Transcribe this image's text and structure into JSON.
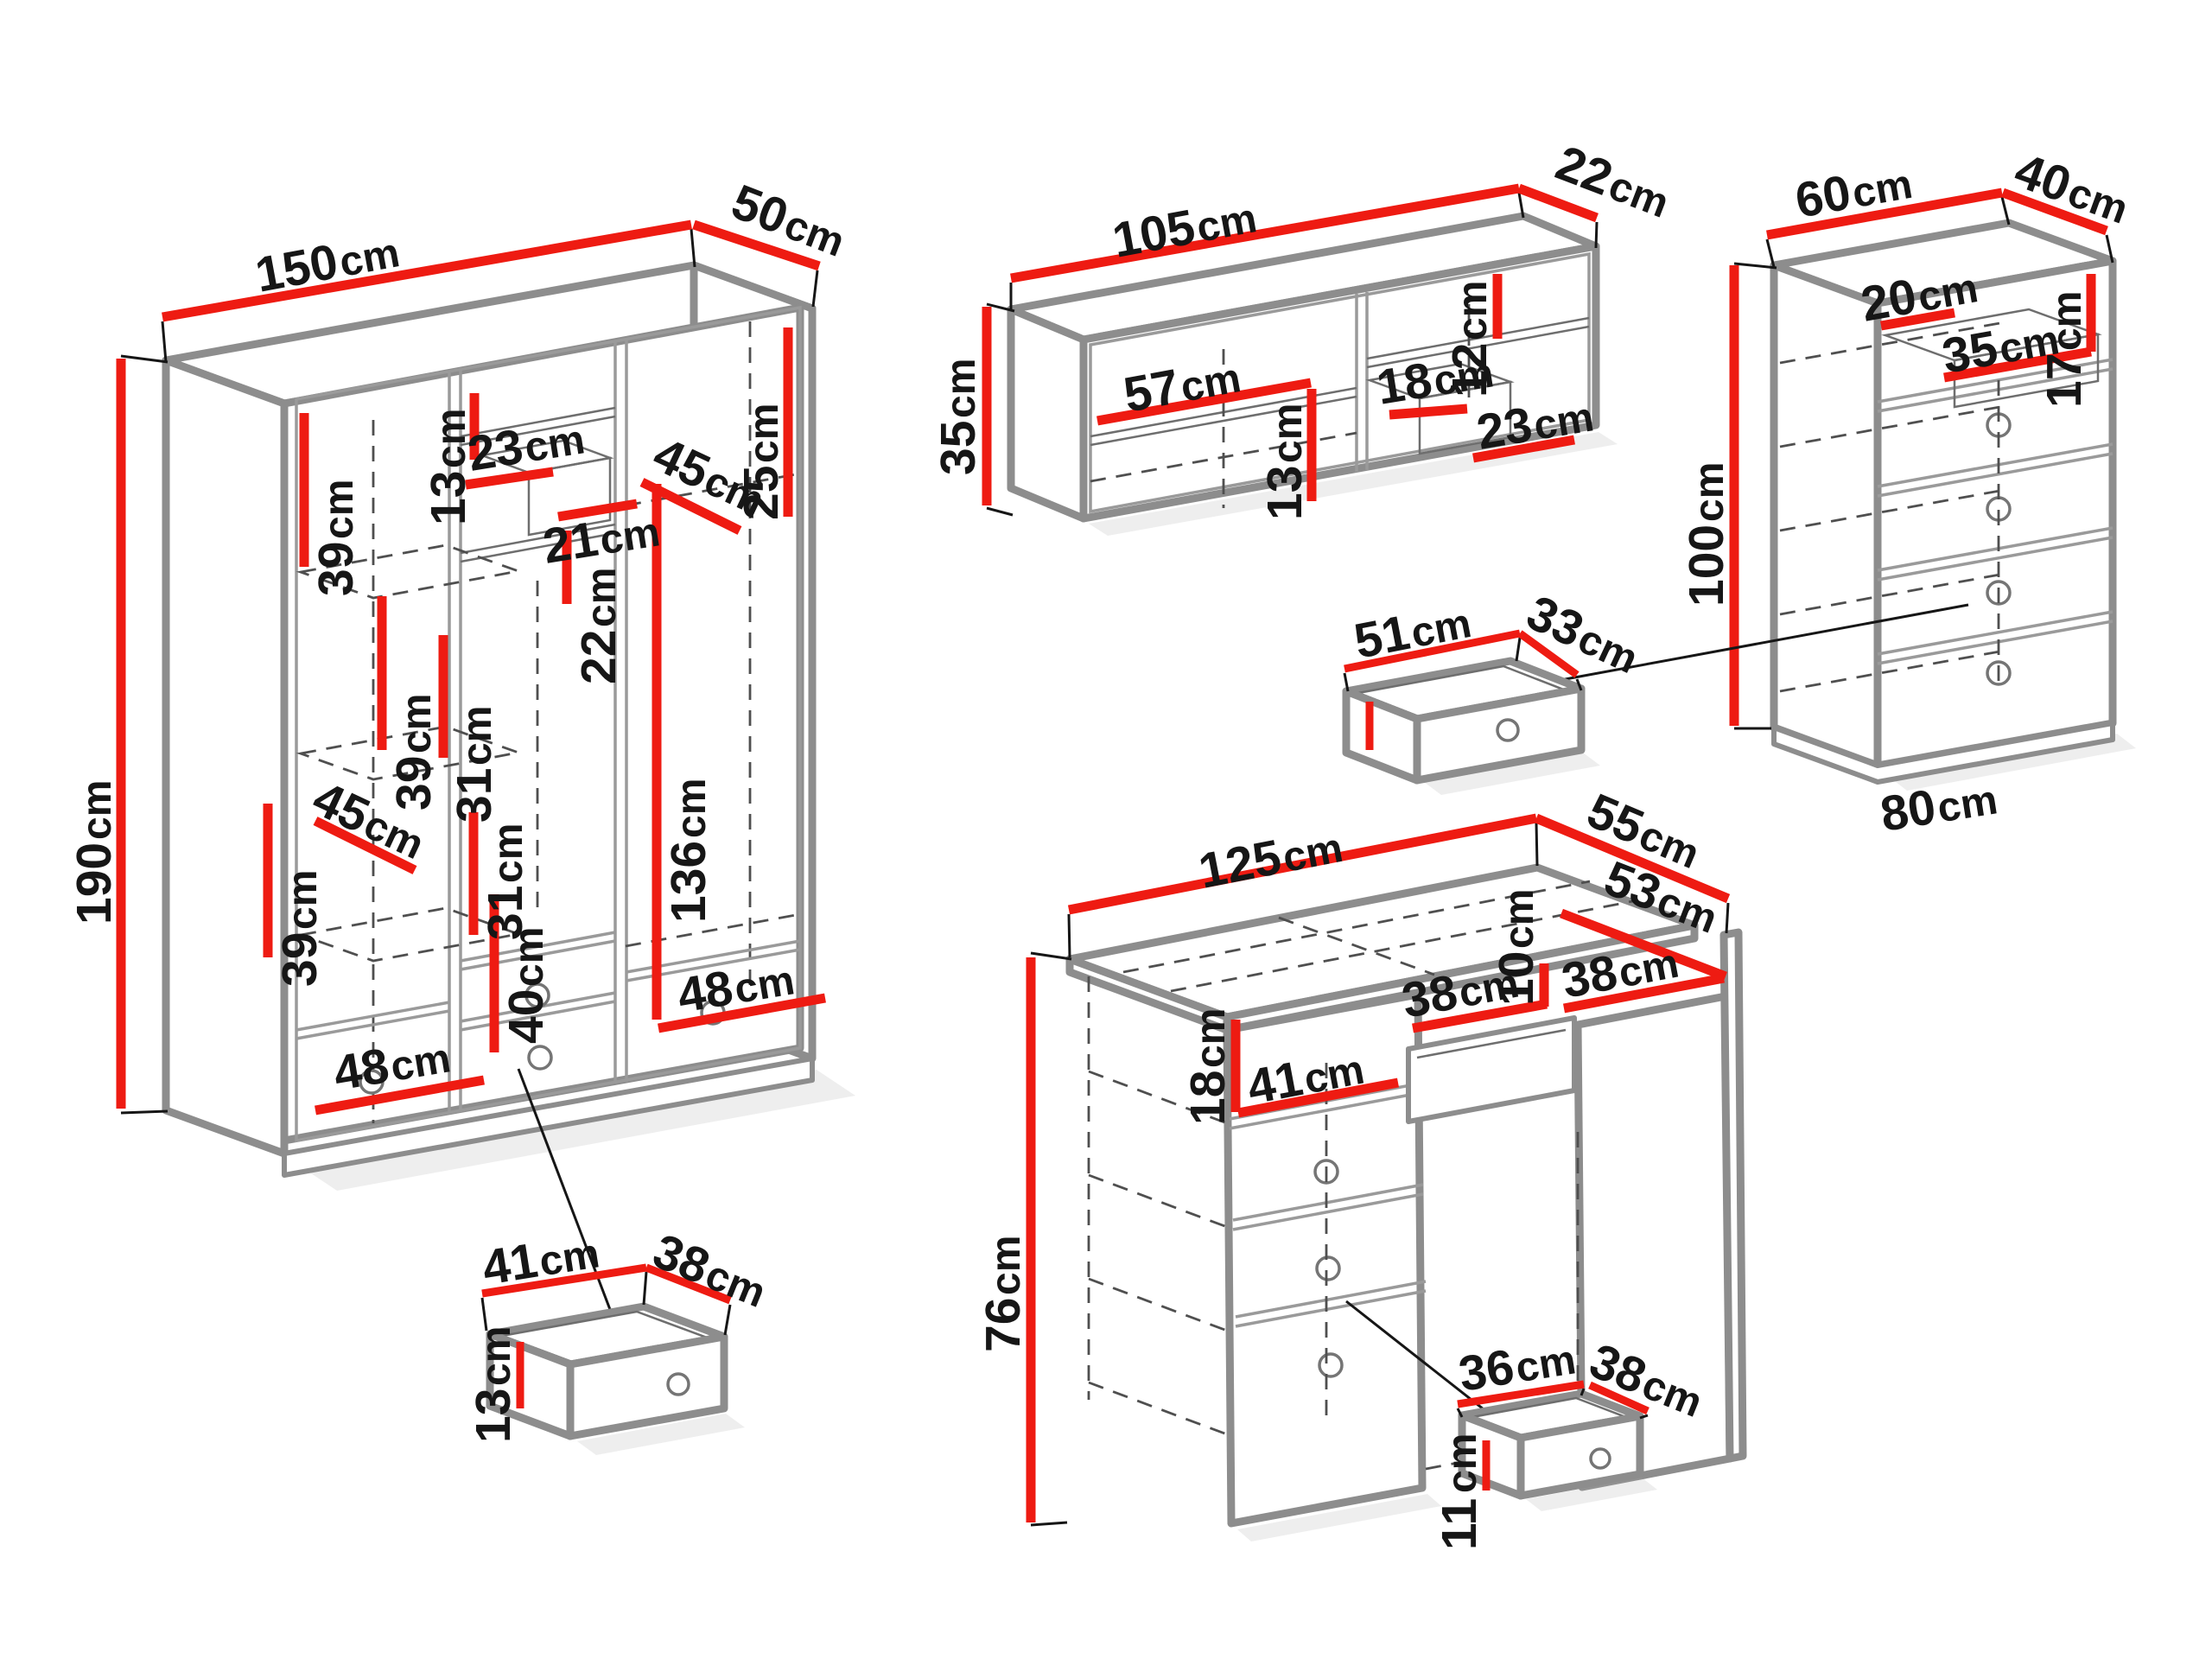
{
  "unit": "cm",
  "diagram_type": "furniture-dimension-drawing",
  "colors": {
    "dimension_line": "#ee1b12",
    "outline": "#8d8d8d",
    "label_text": "#161616",
    "background": "#ffffff"
  },
  "pieces": {
    "wardrobe": {
      "name": "wardrobe",
      "width": "150",
      "depth": "50",
      "height": "190",
      "interior": {
        "shelf_gap_1": "39",
        "top_niche_height": "13",
        "cubby_width_a": "23",
        "cubby_width_b": "21",
        "shelf_depth_upper": "45",
        "right_top_gap": "25",
        "cubby_height": "22",
        "shelf_gap_2": "39",
        "mid_gap_1": "31",
        "shelf_depth_lower": "45",
        "shelf_gap_3": "39",
        "mid_gap_2": "31",
        "hanging_height": "136",
        "drawer_zone_height": "40",
        "drawer_width_left": "48",
        "drawer_width_right": "48"
      },
      "drawer_detail": {
        "width": "41",
        "depth": "38",
        "height": "13"
      }
    },
    "wall_shelf": {
      "name": "wall shelf",
      "width": "105",
      "depth": "22",
      "height": "35",
      "interior": {
        "left_compartment_width": "57",
        "left_compartment_height": "13",
        "right_top_height": "12",
        "inner_box_width": "18",
        "right_bottom_width": "23"
      }
    },
    "chest": {
      "name": "chest of drawers",
      "width": "60",
      "depth": "40",
      "height": "100",
      "base_width": "80",
      "interior": {
        "inner_drawer_width": "20",
        "compartment_width": "35",
        "compartment_height": "17"
      },
      "drawer_detail": {
        "width": "51",
        "depth": "33"
      }
    },
    "desk": {
      "name": "desk",
      "width": "125",
      "depth": "55",
      "height": "76",
      "interior": {
        "top_depth": "53",
        "pencil_drawer_height": "10",
        "pencil_drawer_width": "38",
        "right_panel_width": "38",
        "niche_height": "18",
        "niche_width": "41"
      },
      "drawer_detail": {
        "width": "36",
        "depth": "38",
        "height": "11"
      }
    }
  }
}
